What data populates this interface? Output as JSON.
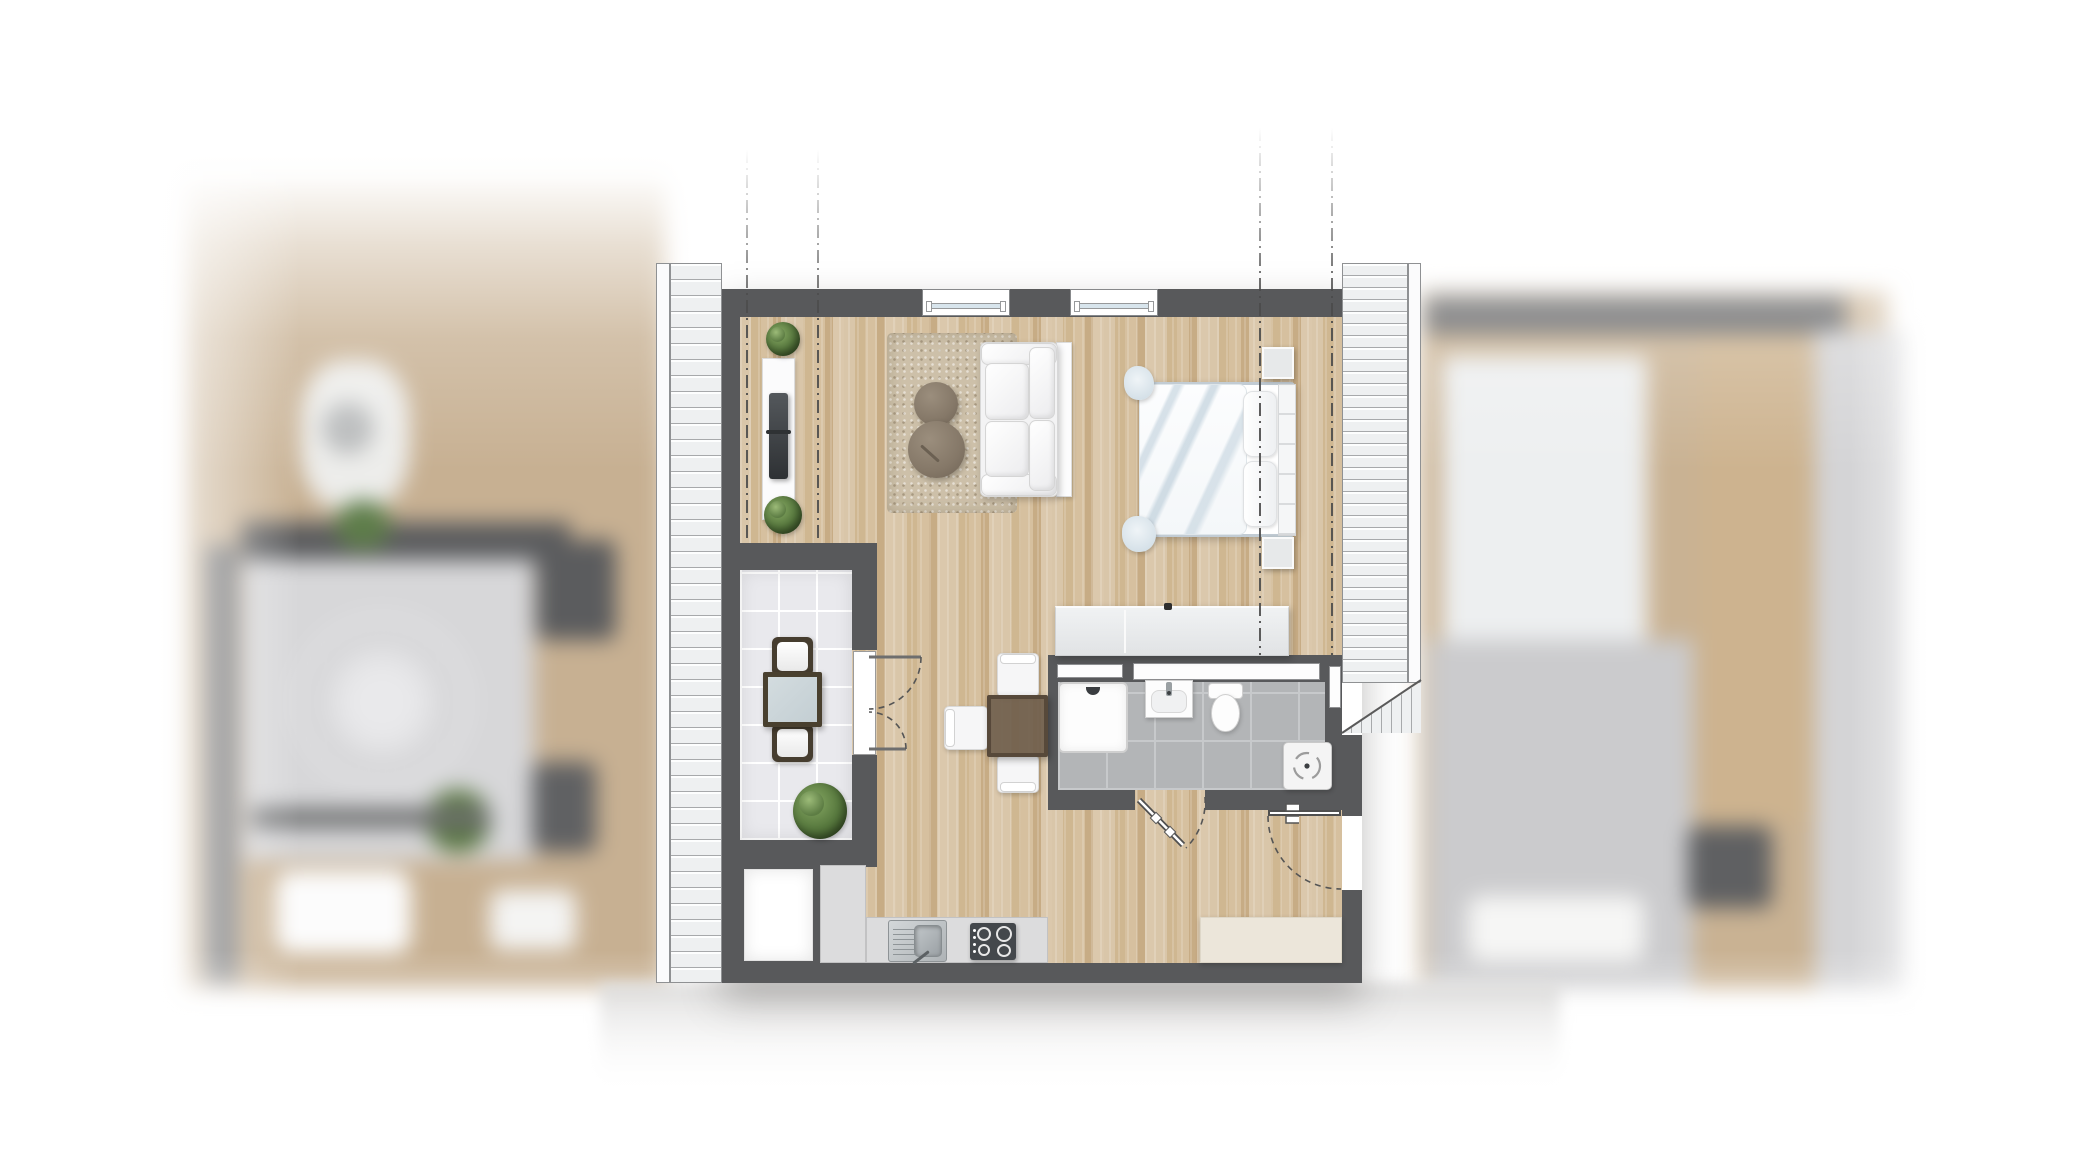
{
  "scene": {
    "type": "apartment-floor-plan-top-view",
    "visible_text": "none",
    "center_unit": "one-room attic apartment with two balconies",
    "blurred_context": [
      "adjacent-unit-left",
      "adjacent-unit-right",
      "corridor-below"
    ]
  },
  "colors": {
    "wall": "#58595b",
    "wood": "#d3bd9e",
    "loggiaTile": "#e9e9ed",
    "bathTile": "#b3b5b7",
    "deck": "#eef0f1",
    "counter": "#dcdcdd",
    "cream": "#ece6da",
    "glass": "#d8e5ed",
    "plantGreen": "#55763c",
    "dashLine": "#4b4b4b",
    "neighborBeige": "#c7b092",
    "neighborGray": "#d7d7d9",
    "neighborDark": "#5b5c5e",
    "corridor": "#d2d1d0"
  },
  "symbols": [
    "balcony-deck-left",
    "balcony-deck-right",
    "section-dash-lines",
    "window",
    "sofa",
    "rug",
    "pouf",
    "tv-sideboard",
    "potted-plant",
    "double-bed",
    "nightstand",
    "wardrobe",
    "desk-table",
    "chair",
    "loggia-dining-table",
    "loggia-chairs",
    "shower-tray",
    "washbasin",
    "toilet",
    "washing-machine",
    "kitchen-counter",
    "kitchen-sink",
    "cooktop",
    "entry-sideboard",
    "storage-room",
    "door-swing-arcs"
  ]
}
